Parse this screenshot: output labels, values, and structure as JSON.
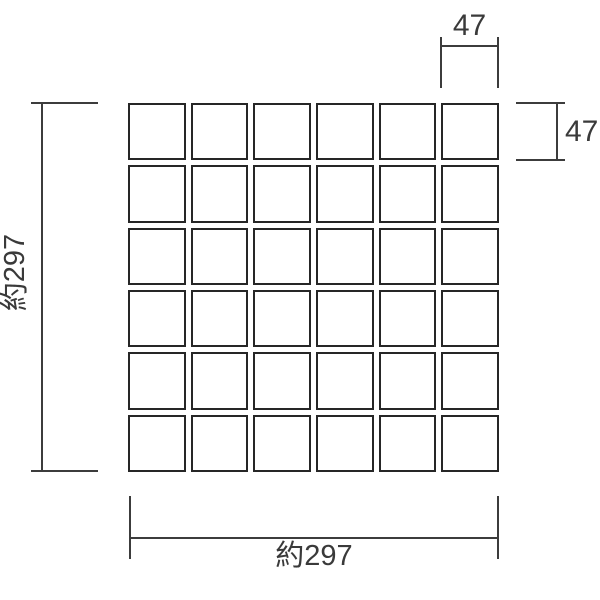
{
  "diagram": {
    "title": "mosaic-tile-sheet-dimension-drawing",
    "grid": {
      "rows": 6,
      "cols": 6,
      "tile_count": 36
    },
    "dimensions": {
      "top": {
        "label": "47"
      },
      "right": {
        "label": "47"
      },
      "left": {
        "label": "約297"
      },
      "bottom": {
        "label": "約297"
      }
    },
    "colors": {
      "background": "#ffffff",
      "line": "#3c3c3c",
      "tile_border": "#262626",
      "tile_fill": "#ffffff",
      "text": "#3a3a3a"
    }
  }
}
